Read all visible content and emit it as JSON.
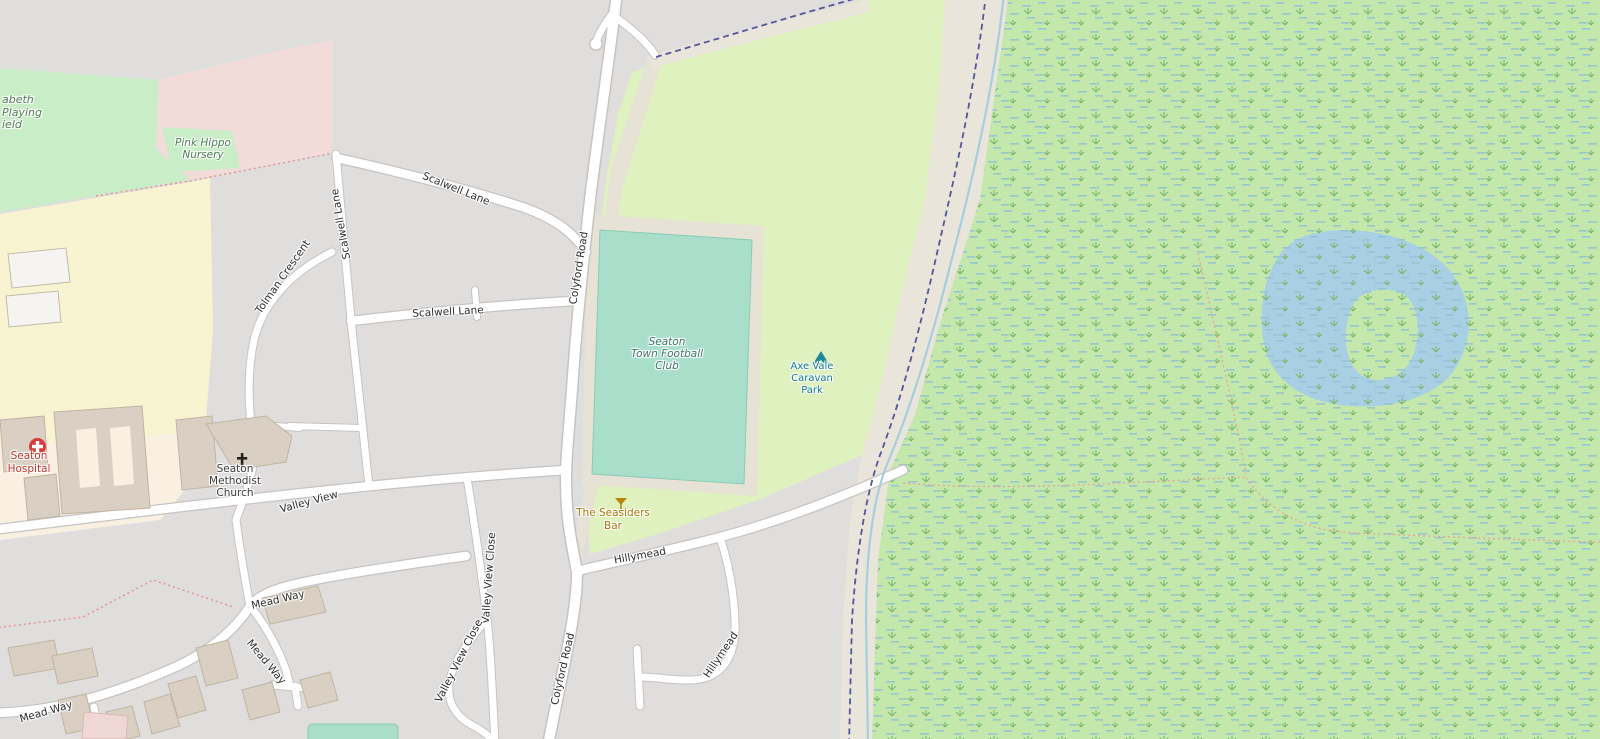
{
  "labels": {
    "roads": [
      {
        "id": "scalwell-lane-upper",
        "text": "Scalwell Lane"
      },
      {
        "id": "scalwell-lane-vertical",
        "text": "Scalwell Lane"
      },
      {
        "id": "scalwell-lane-lower",
        "text": "Scalwell Lane"
      },
      {
        "id": "tolman-crescent",
        "text": "Tolman Crescent"
      },
      {
        "id": "colyford-road-upper",
        "text": "Colyford Road"
      },
      {
        "id": "colyford-road-lower",
        "text": "Colyford Road"
      },
      {
        "id": "valley-view",
        "text": "Valley View"
      },
      {
        "id": "valley-view-close-main",
        "text": "Valley View Close"
      },
      {
        "id": "valley-view-close-loop",
        "text": "Valley View Close"
      },
      {
        "id": "mead-way-east",
        "text": "Mead Way"
      },
      {
        "id": "mead-way-diagonal",
        "text": "Mead Way"
      },
      {
        "id": "mead-way-west",
        "text": "Mead Way"
      },
      {
        "id": "hillymead-upper",
        "text": "Hillymead"
      },
      {
        "id": "hillymead-lower",
        "text": "Hillymead"
      }
    ],
    "places": {
      "playing_field": {
        "lines": [
          "abeth",
          "Playing",
          "ield"
        ],
        "color": "#4d7e52"
      },
      "nursery": {
        "lines": [
          "Pink Hippo",
          "Nursery"
        ],
        "color": "#4d7e52"
      },
      "football_club": {
        "lines": [
          "Seaton",
          "Town Football",
          "Club"
        ],
        "color": "#3f7668"
      },
      "caravan_park": {
        "lines": [
          "Axe Vale",
          "Caravan",
          "Park"
        ],
        "color": "#0e7a8e",
        "icon": "tent-icon"
      },
      "hospital": {
        "lines": [
          "Seaton",
          "Hospital"
        ],
        "color": "#c0392b",
        "icon": "hospital-cross-icon"
      },
      "church": {
        "lines": [
          "Seaton",
          "Methodist",
          "Church"
        ],
        "color": "#3c3c3c",
        "icon": "christian-cross-icon"
      },
      "bar": {
        "lines": [
          "The Seasiders",
          "Bar"
        ],
        "color": "#a8780a",
        "icon": "bar-glass-icon"
      }
    }
  },
  "colors": {
    "residential_gray": "#e0dedd",
    "field_green": "#c9edc6",
    "caravan_green": "#def1be",
    "pitch_teal": "#a9dfca",
    "wetland_green": "#c4e7ab",
    "water_blue": "#a9cfe5",
    "hospital_cream": "#f9f0e2",
    "yellow_area": "#f8f3d1",
    "pink_area": "#f2dcda",
    "track_beige": "#eae5da",
    "road_white": "#ffffff",
    "road_casing": "#c6c3c1",
    "boundary_purple": "#55559b",
    "stream_blue": "#a5cede",
    "footpath_red": "#e58f8f",
    "footpath_orange": "#e8a394",
    "building_tan": "#d9d0c3"
  }
}
